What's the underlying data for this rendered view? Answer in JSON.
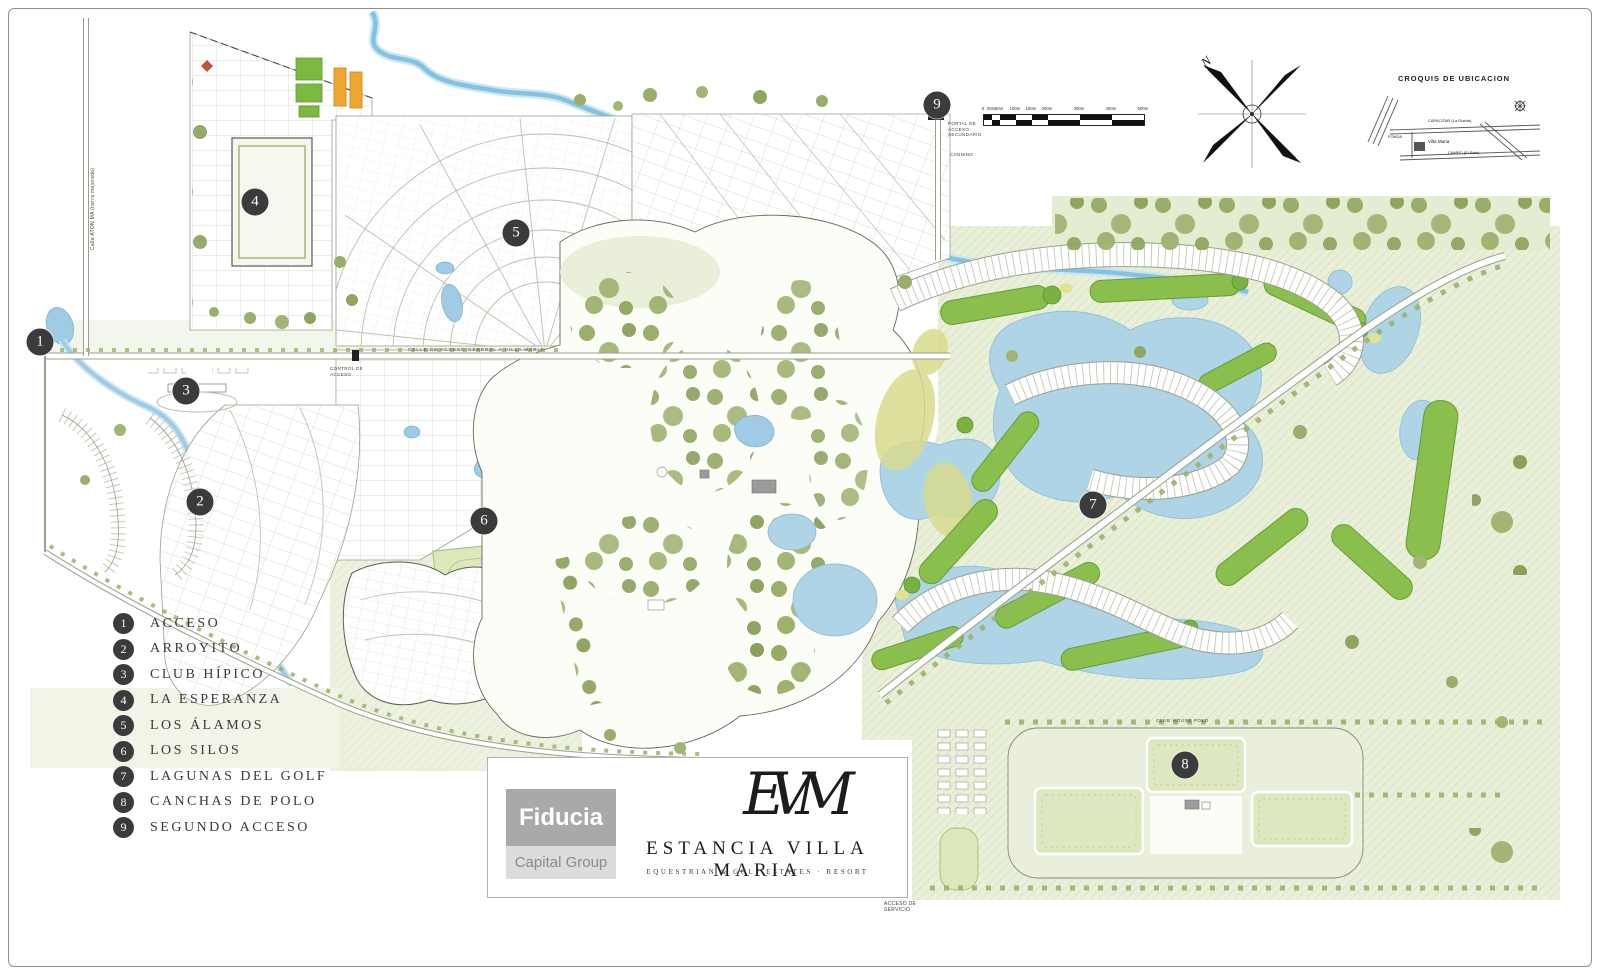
{
  "page": {
    "background": "#ffffff",
    "frame_color": "#8f8f8f"
  },
  "legend": {
    "items": [
      {
        "num": "1",
        "label": "ACCESO"
      },
      {
        "num": "2",
        "label": "ARROYITO"
      },
      {
        "num": "3",
        "label": "CLUB HÍPICO"
      },
      {
        "num": "4",
        "label": "LA ESPERANZA"
      },
      {
        "num": "5",
        "label": "LOS ÁLAMOS"
      },
      {
        "num": "6",
        "label": "LOS SILOS"
      },
      {
        "num": "7",
        "label": "LAGUNAS DEL GOLF"
      },
      {
        "num": "8",
        "label": "CANCHAS DE POLO"
      },
      {
        "num": "9",
        "label": "SEGUNDO ACCESO"
      }
    ]
  },
  "map": {
    "markers": [
      {
        "num": "1",
        "name": "ACCESO"
      },
      {
        "num": "2",
        "name": "ARROYITO"
      },
      {
        "num": "3",
        "name": "CLUB HÍPICO"
      },
      {
        "num": "4",
        "name": "LA ESPERANZA"
      },
      {
        "num": "5",
        "name": "LOS ÁLAMOS"
      },
      {
        "num": "6",
        "name": "LOS SILOS"
      },
      {
        "num": "7",
        "name": "LAGUNAS DEL GOLF"
      },
      {
        "num": "8",
        "name": "CANCHAS DE POLO"
      },
      {
        "num": "9",
        "name": "SEGUNDO ACCESO"
      }
    ]
  },
  "annotations": {
    "portal_line1": "PORTAL DE",
    "portal_line2": "ACCESO",
    "portal_line3": "SECUNDARIO",
    "canning": "CANNING",
    "control_line1": "CONTROL DE",
    "control_line2": "ACCESO",
    "servicio_line1": "ACCESO DE",
    "servicio_line2": "SERVICIO",
    "calle_acceso": "CALLE DE ACCESO GENERAL A VILLA MARIA",
    "calle_izquierda": "Calle ATON MA  (tierra mejorada)",
    "club_house_polo": "CLUB HOUSE POLO"
  },
  "compass": {
    "north_label": "N"
  },
  "scale_bar": {
    "labels": [
      "0",
      "25m",
      "50m",
      "100m",
      "150m",
      "200m",
      "300m",
      "400m",
      "500m"
    ]
  },
  "croquis": {
    "title": "CROQUIS DE UBICACION",
    "road_top": "CAPACITAR (La Rueda)",
    "site_label": "Villa Maria",
    "road_left": "FONDA",
    "road_bottom": "CAMPO (El Pato)"
  },
  "title_block": {
    "monogram": "EVM",
    "title": "ESTANCIA VILLA MARIA",
    "subtitle": "EQUESTRIAN   &   GOLF ESTATES   ·   RESORT"
  },
  "developer": {
    "name": "Fiducia",
    "division": "Capital Group"
  },
  "colors": {
    "water": "#9fcbe4",
    "fairway": "#8abf4d",
    "pale_field": "#e9efd9",
    "tree_olive": "#9aae6a",
    "marker": "#3b3b3b",
    "orange_building": "#f0a732"
  }
}
